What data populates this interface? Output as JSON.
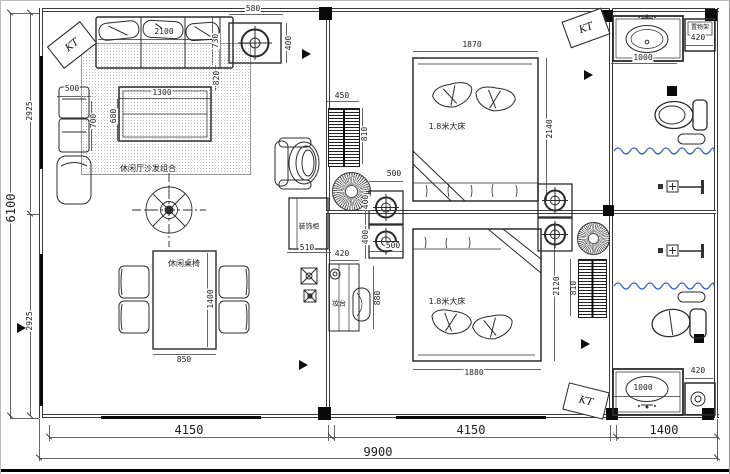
{
  "labels": {
    "kt": "KT",
    "sofa_group": "休闲厅沙发组合",
    "dining_set": "休闲桌椅",
    "double_bed": "1.8米大床",
    "decor_cabinet": "装饰柜",
    "dressing_table": "妆台",
    "shelf_rack": "置物架"
  },
  "dims": {
    "sofa_len": "2100",
    "sofa_depth": "730",
    "sofa_gap": "820",
    "ac_w": "580",
    "ac_h": "400",
    "side_table_w": "500",
    "side_table_h": "700",
    "coffee_w": "1300",
    "coffee_h": "680",
    "left_top": "2925",
    "left_total": "6100",
    "left_bottom": "2925",
    "radiator_w": "450",
    "radiator_h": "810",
    "bed1_w": "1870",
    "bed1_h": "2140",
    "spot_w": "500",
    "spot_h": "400",
    "wash_counter_w": "1000",
    "shelf_w": "420",
    "dining_w": "850",
    "dining_h": "1400",
    "cabinet_w": "510",
    "dresser_w": "420",
    "dresser_h": "880",
    "bed2_w": "1880",
    "bed2_h": "2120",
    "bottom_left": "4150",
    "bottom_mid": "4150",
    "bottom_right": "1400",
    "bottom_total": "9900"
  },
  "colors": {
    "line": "#3a3a3a",
    "dim_text": "#1e1e1e",
    "water_wave": "#3b5bbf",
    "rug_hatch": "#b9b9b9"
  }
}
